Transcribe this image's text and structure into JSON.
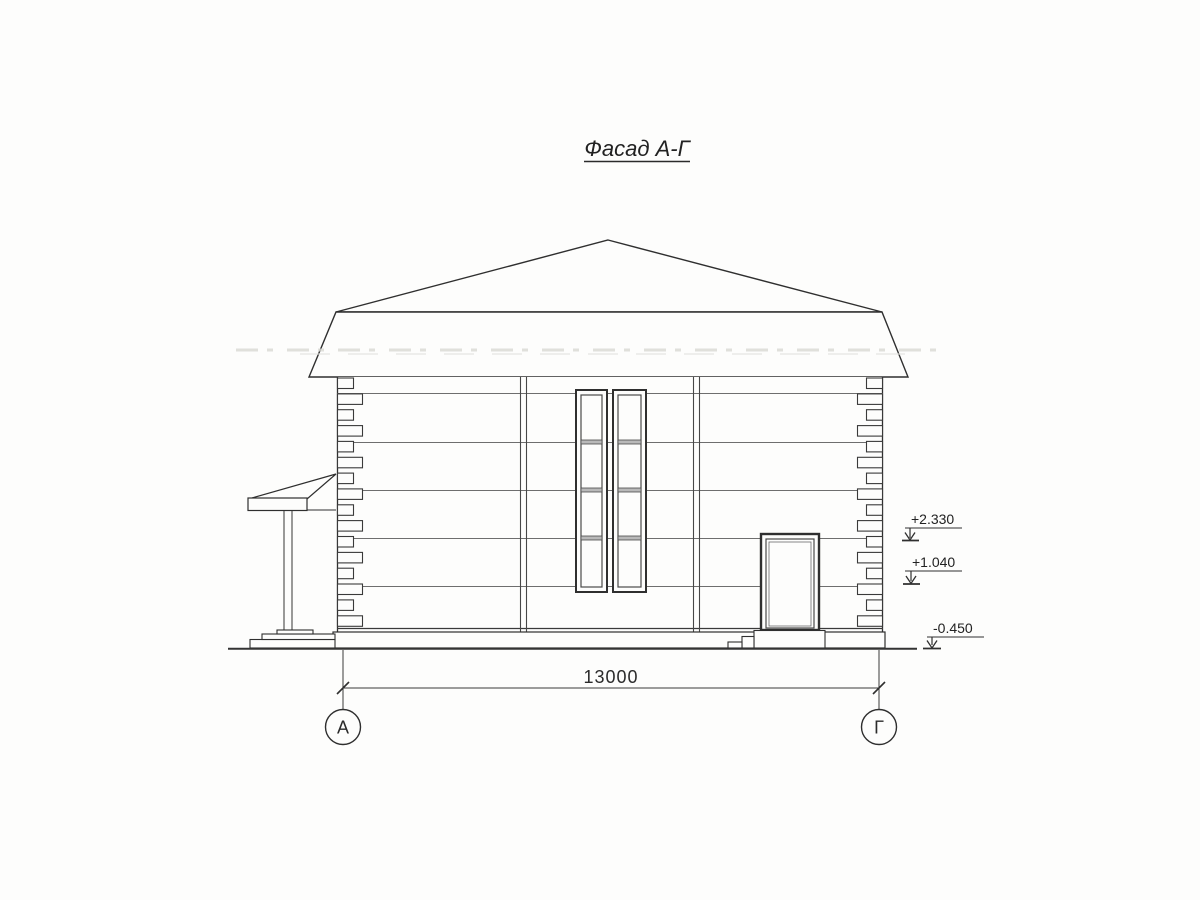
{
  "page": {
    "background": "#fdfdfc",
    "ink_color": "#2f2f2f",
    "thin_line_color": "#6e6e6e"
  },
  "drawing": {
    "title": "Фасад А-Г",
    "dimension_label": "13000",
    "axis_markers": [
      {
        "label": "А"
      },
      {
        "label": "Г"
      }
    ],
    "elevation_marks": [
      {
        "value": "+2.330"
      },
      {
        "value": "+1.040"
      },
      {
        "value": "-0.450"
      }
    ]
  }
}
